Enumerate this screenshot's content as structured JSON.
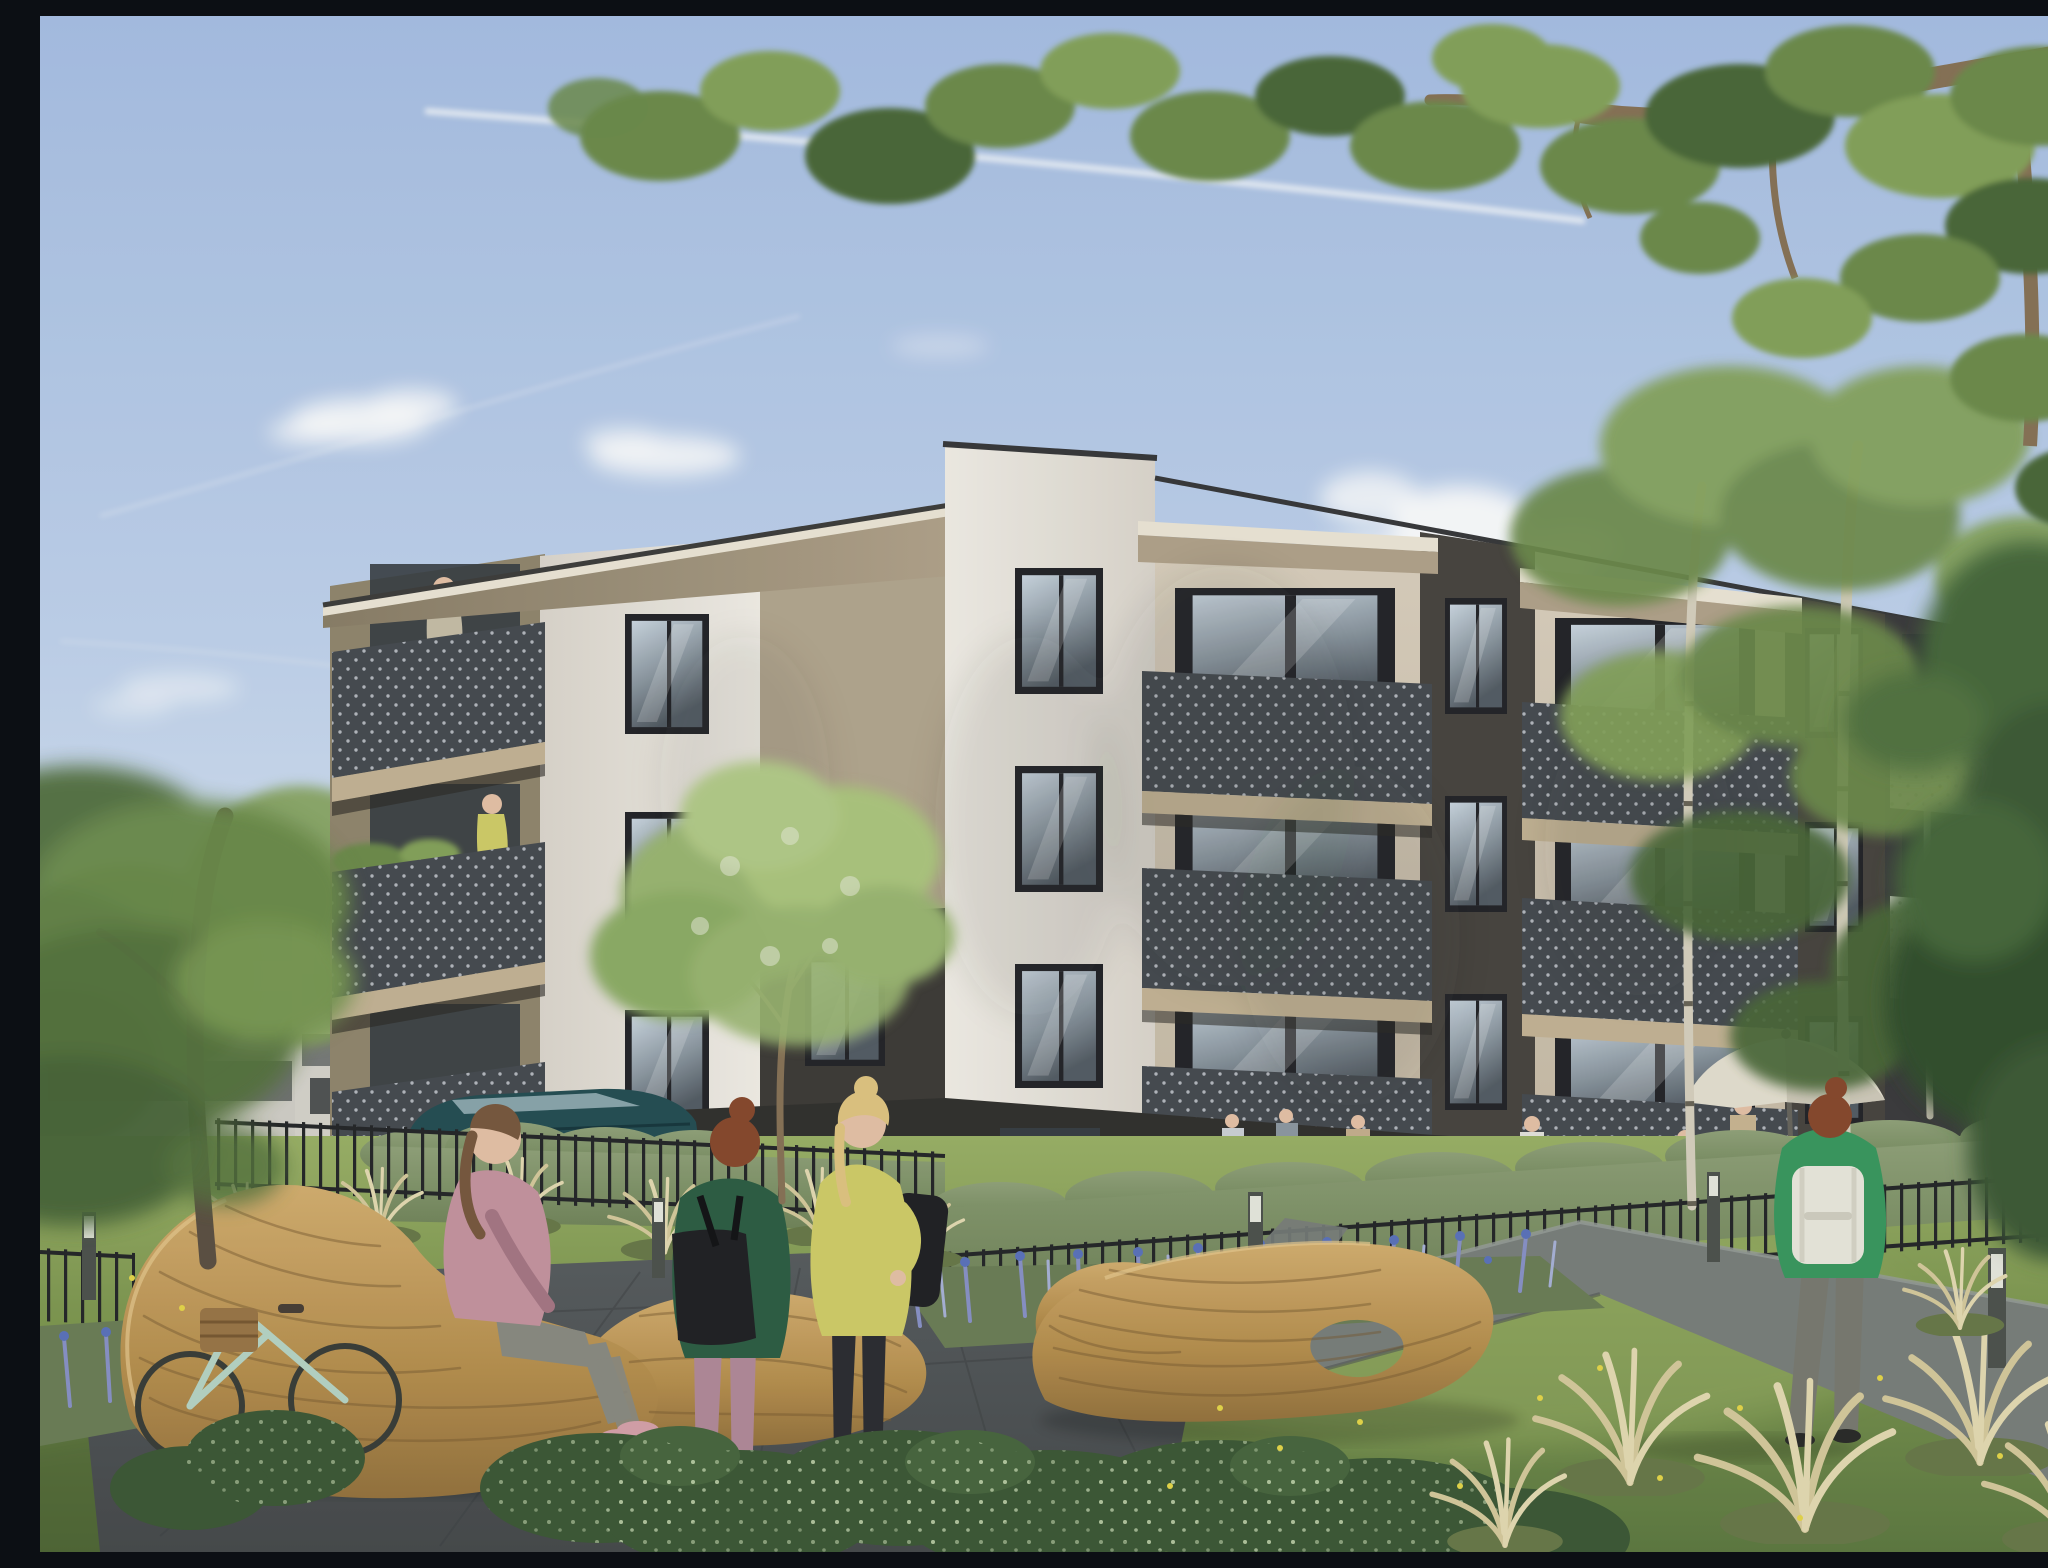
{
  "scene": {
    "type": "architectural-visualization",
    "description": "Sunny photorealistic render of a modern four-storey apartment complex with white, cream and anthracite facades, dark perforated-steel balconies, landscaped courtyard with organic wooden benches, ornamental grasses, lavender beds, paths, bollard lights and residents relaxing outdoors under a blue sky with clouds and contrails.",
    "objects": {
      "sky": {
        "label": "blue summer sky with soft clouds and jet contrails"
      },
      "building_main": {
        "label": "four-storey apartment building, white and cream render with anthracite recesses and perforated dark balconies"
      },
      "left_wing": {
        "label": "left wing with stacked full-width balconies and wedge roof canopy"
      },
      "right_wing": {
        "label": "front wing with two cream balcony bays and dark recessed strips"
      },
      "distant_building": {
        "label": "neighbouring low apartment blocks behind trees"
      },
      "balcony_man": {
        "label": "man standing on top-floor balcony"
      },
      "balcony_woman": {
        "label": "woman in yellow tending balcony plants"
      },
      "terrace_people": {
        "label": "residents sitting at ground-floor terraces"
      },
      "umbrella": {
        "label": "beige patio umbrella on terrace"
      },
      "bench_left": {
        "label": "organic curved wooden slat bench"
      },
      "bench_right": {
        "label": "sculptural wooden lounger with oval cut-out"
      },
      "sitting_woman": {
        "label": "woman in pink sweater sitting on wooden bench"
      },
      "standing_woman_green": {
        "label": "woman in green jacket with black shoulder bag"
      },
      "standing_woman_yellow": {
        "label": "blonde woman in yellow cardigan with black backpack"
      },
      "walking_woman": {
        "label": "woman in green jacket with white backpack walking away on path"
      },
      "distant_person": {
        "label": "resident walking in the far courtyard"
      },
      "bicycle": {
        "label": "mint city bicycle with wicker basket leaning on bench"
      },
      "car": {
        "label": "dark teal SUV parked behind the fence"
      },
      "fence": {
        "label": "black metal picket fence"
      },
      "hedge": {
        "label": "clipped green hedge along terraces"
      },
      "plaza": {
        "label": "dark paved seating plaza"
      },
      "path": {
        "label": "grey concrete walkway"
      },
      "bollard": {
        "label": "cylindrical bollard light"
      },
      "lavender_bed": {
        "label": "perennial bed with blue and violet flowers"
      },
      "grass_tuft": {
        "label": "straw-coloured ornamental grass"
      },
      "shrubs": {
        "label": "low green shrubs"
      },
      "lawn": {
        "label": "sunlit lawn with dandelions"
      },
      "tree_left": {
        "label": "tall leafy tree at left edge"
      },
      "tree_center": {
        "label": "small flowering ornamental tree"
      },
      "birches": {
        "label": "young birch trees in front of the right wing"
      },
      "tree_right": {
        "label": "large tree with overhanging branches at top right"
      }
    },
    "counts": {
      "floors": 4,
      "balcony_rows_left_wing": 3,
      "balcony_bays_front": 2,
      "people_foreground": 3,
      "bollards": 5
    }
  },
  "palette": {
    "sky_top": "#a9c0e5",
    "sky_mid": "#c2d4ee",
    "sky_low": "#dde8f5",
    "sky_horizon": "#e9eff7",
    "cloud_white": "#ffffff",
    "facade_white_lit": "#f4f0e8",
    "facade_white_shade": "#ded8cf",
    "facade_white_dim": "#cfc9c0",
    "facade_cream": "#dcd1bf",
    "facade_cream_shade": "#c6b9a3",
    "facade_taupe": "#b5a890",
    "facade_taupe_shade": "#93886f",
    "facade_dark": "#3e3d3f",
    "facade_dark2": "#2e2d2f",
    "facade_dark_warm": "#4a4641",
    "canopy_top": "#efe8d8",
    "canopy_under": "#b3a48c",
    "canopy_under_dark": "#8c8069",
    "window_frame": "#26262a",
    "glass_light": "#cdd8e2",
    "glass_mid": "#8e99a2",
    "glass_dark": "#565e66",
    "glass_int": "#3a4045",
    "rail_dark": "#484c52",
    "rail_dark2": "#383c42",
    "rail_dot": "#c9cdd2",
    "rail_light": "#d9d7cf",
    "slab_beige": "#c6b596",
    "slab_shadow": "#2e2b27",
    "grass_light": "#9db268",
    "grass_mid": "#7f9851",
    "grass_dark": "#5f7a42",
    "grass_deep": "#44592f",
    "hedge_green": "#72855a",
    "hedge_light": "#93a47b",
    "shrub_dark": "#3f5a38",
    "shrub_mid": "#4a6840",
    "shrub_speckle": "#cfe0b8",
    "straw": "#d8cb9e",
    "straw_light": "#e6dcb4",
    "straw_base": "#6b7a4a",
    "lavender": "#8b93c8",
    "lavender_blue": "#5d74bd",
    "lavender_pale": "#aab3d8",
    "bed_green": "#6e7f58",
    "plaza_top": "#5a5e60",
    "plaza_bot": "#484b4d",
    "plaza_joint": "#3f4244",
    "path_gray": "#7b807c",
    "path_light": "#9aa09b",
    "wood_lit": "#d6b071",
    "wood_mid": "#b8904f",
    "wood_dark": "#97743f",
    "wood_line": "#7a5c33",
    "wood_hi": "#e8cb90",
    "trunk": "#5e5244",
    "trunk_light": "#8a7458",
    "birch": "#d9d2c0",
    "birch_fleck": "#6b6558",
    "fol_dark": "#4d6b3a",
    "fol_mid": "#6f8d4e",
    "fol_light": "#87a45c",
    "fol_pale": "#a8bf7c",
    "fol_bloom": "#e9edd8",
    "car_teal": "#275055",
    "car_glass": "#9fb6bd",
    "skin": "#e8c3a8",
    "hair_brown": "#7a5a40",
    "hair_red": "#8a4a2e",
    "hair_blonde": "#e2c683",
    "outfit_pink": "#c795a1",
    "pants_gray": "#8c8c83",
    "shoe_pink": "#d8a3ab",
    "outfit_green": "#2f5f45",
    "pants_mauve": "#b38b9b",
    "shoe_white": "#e8e8e6",
    "outfit_yellow": "#d3cf6a",
    "pants_black": "#2e2e33",
    "bag_black": "#232326",
    "outfit_green2": "#3c9a60",
    "backpack_white": "#eceade",
    "pants_gray2": "#7b7b72",
    "umbrella": "#e7e1d2",
    "umbrella_shade": "#c9c2b2",
    "bollard_dark": "#50544f",
    "bollard_light": "#e9eadf",
    "fence_black": "#27282a",
    "distant_wall": "#d3d0c8",
    "distant_band": "#5b5e5e",
    "dandelion": "#e8d84a"
  }
}
